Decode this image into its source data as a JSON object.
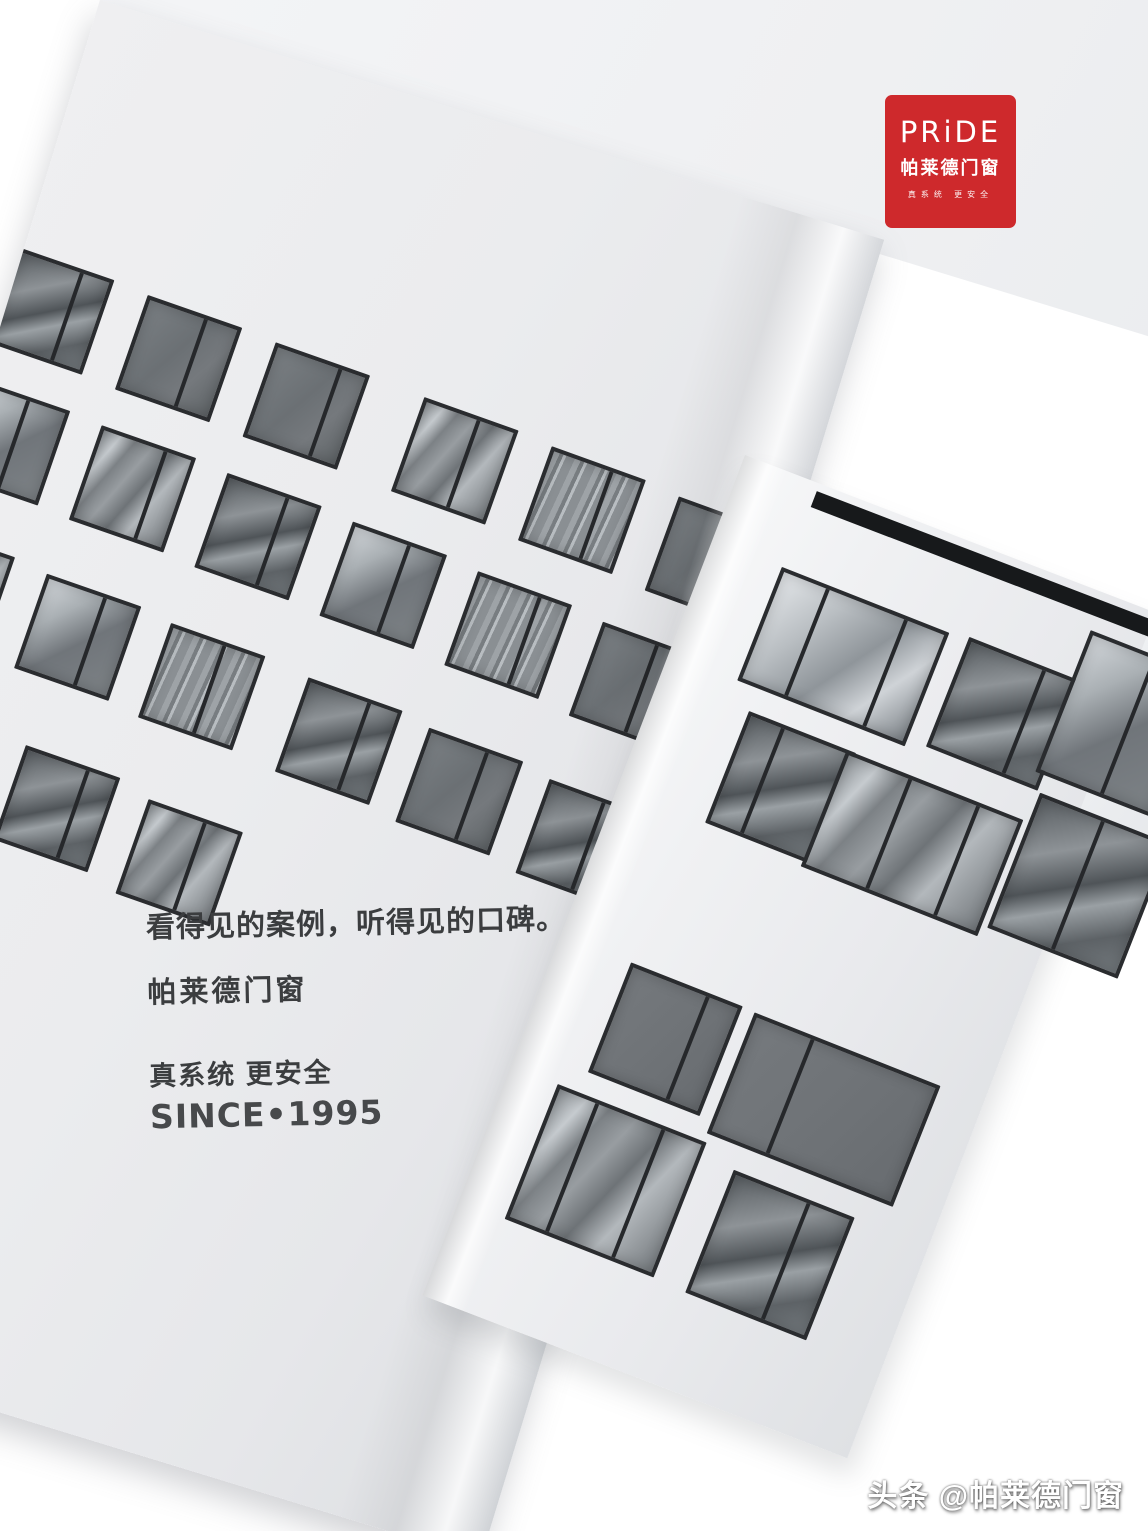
{
  "logo": {
    "wordmark": "PRiDE",
    "name_cn": "帕莱德门窗",
    "slogan": "真系统 更安全",
    "bg_color": "#ce292c",
    "fg_color": "#ffffff"
  },
  "copy": {
    "headline": "看得见的案例，听得见的口碑。",
    "brand": "帕莱德门窗",
    "slogan": "真系统 更安全",
    "since": "SINCE•1995"
  },
  "watermark": {
    "text": "头条 @帕莱德门窗"
  },
  "colors": {
    "background": "#ffffff",
    "page": "#ebecee",
    "tile_frame": "#2a2c2f",
    "roof_bar": "#17191b",
    "text": "#3b3d3f",
    "logo_red": "#ce292c"
  },
  "illustration": {
    "variants": {
      "v1": "linear-gradient(112deg,#8d9296 0%,#c6cbcf 14%,#7c8185 26%,#989da1 40%,#6e7377 55%,#b3b8bc 70%,#777c80 100%)",
      "v2": "linear-gradient(120deg,#7a7f83 0%,#6b7074 45%,#75797d 70%,#606568 100%)",
      "v3": "repeating-linear-gradient(95deg,#9ea3a7 0px,#9ea3a7 6px,#787d81 6px,#787d81 10px,#b8bdc1 10px,#b8bdc1 13px,#8a8f93 13px,#8a8f93 22px)",
      "v4": "linear-gradient(135deg,#d2d6da 0%,#aab0b4 28%,#70757a 55%,#7d8286 100%)",
      "v5": "linear-gradient(115deg,#75797d 0%,#6e7276 60%,#686c70 100%)",
      "v6": "linear-gradient(150deg,#585d61 0%,#8e9397 30%,#4f5458 50%,#9aa0a4 62%,#5d6266 80%,#747a7e 100%)",
      "v7": "linear-gradient(125deg,#e3e6e9 0%,#b9bec2 30%,#8f959a 55%,#cfd3d7 75%,#7f858a 100%)"
    },
    "left_tiles": [
      {
        "x": -6,
        "y": 262,
        "v": "v6",
        "m": [
          66
        ],
        "r": 2.0
      },
      {
        "x": 130,
        "y": 270,
        "v": "v2",
        "m": [
          62
        ],
        "r": 2.2
      },
      {
        "x": 266,
        "y": 278,
        "v": "v2",
        "m": [
          70
        ],
        "r": 2.4
      },
      {
        "x": 424,
        "y": 287,
        "v": "v1",
        "m": [
          58
        ],
        "r": 2.6
      },
      {
        "x": 560,
        "y": 297,
        "v": "v3",
        "m": [
          64
        ],
        "r": 2.8
      },
      {
        "x": 696,
        "y": 308,
        "v": "v2",
        "m": [
          60
        ],
        "r": 3.0
      },
      {
        "x": -10,
        "y": 400,
        "v": "v4",
        "m": [
          55
        ],
        "r": 2.0
      },
      {
        "x": 124,
        "y": 408,
        "v": "v1",
        "m": [
          68
        ],
        "r": 2.2
      },
      {
        "x": 258,
        "y": 417,
        "v": "v6",
        "m": [
          64
        ],
        "r": 2.4
      },
      {
        "x": 392,
        "y": 427,
        "v": "v4",
        "m": [
          60
        ],
        "r": 2.6
      },
      {
        "x": 526,
        "y": 438,
        "v": "v3",
        "m": [
          66
        ],
        "r": 2.8
      },
      {
        "x": 660,
        "y": 450,
        "v": "v2",
        "m": [
          58
        ],
        "r": 3.0
      },
      {
        "x": -20,
        "y": 556,
        "v": "v1",
        "m": [
          70
        ],
        "r": 2.0
      },
      {
        "x": 115,
        "y": 566,
        "v": "v4",
        "m": [
          62
        ],
        "r": 2.2
      },
      {
        "x": 248,
        "y": 577,
        "v": "v3",
        "m": [
          57
        ],
        "r": 2.4
      },
      {
        "x": 395,
        "y": 589,
        "v": "v6",
        "m": [
          65
        ],
        "r": 2.6
      },
      {
        "x": 525,
        "y": 602,
        "v": "v2",
        "m": [
          62
        ],
        "r": 2.8
      },
      {
        "x": 655,
        "y": 616,
        "v": "v6",
        "m": [
          58
        ],
        "r": 3.0
      },
      {
        "x": 145,
        "y": 736,
        "v": "v6",
        "m": [
          66
        ],
        "r": 2.2
      },
      {
        "x": 278,
        "y": 752,
        "v": "v1",
        "m": [
          60
        ],
        "r": 2.4
      }
    ],
    "right_tiles": [
      {
        "x": 74,
        "y": 92,
        "w": 180,
        "h": 122,
        "v": "v7",
        "m": [
          26,
          75
        ],
        "r": 0.5
      },
      {
        "x": 274,
        "y": 90,
        "w": 120,
        "h": 118,
        "v": "v6",
        "m": [
          68
        ],
        "r": 0.6
      },
      {
        "x": 385,
        "y": 40,
        "w": 125,
        "h": 152,
        "v": "v4",
        "m": [
          55
        ],
        "r": 0.4
      },
      {
        "x": 95,
        "y": 238,
        "w": 115,
        "h": 120,
        "v": "v6",
        "m": [
          30
        ],
        "r": 0.5
      },
      {
        "x": 200,
        "y": 240,
        "w": 190,
        "h": 125,
        "v": "v1",
        "m": [
          35,
          75
        ],
        "r": 0.6
      },
      {
        "x": 396,
        "y": 210,
        "w": 140,
        "h": 145,
        "v": "v6",
        "m": [
          48
        ],
        "r": 0.4
      },
      {
        "x": 75,
        "y": 515,
        "w": 120,
        "h": 118,
        "v": "v5",
        "m": [
          70
        ],
        "r": 0.5
      },
      {
        "x": 208,
        "y": 518,
        "w": 200,
        "h": 130,
        "v": "v5",
        "m": [
          30
        ],
        "r": 0.6
      },
      {
        "x": 50,
        "y": 655,
        "w": 160,
        "h": 145,
        "v": "v1",
        "m": [
          25,
          72
        ],
        "r": 0.5
      },
      {
        "x": 245,
        "y": 672,
        "w": 130,
        "h": 132,
        "v": "v6",
        "m": [
          62
        ],
        "r": 0.6
      }
    ]
  }
}
